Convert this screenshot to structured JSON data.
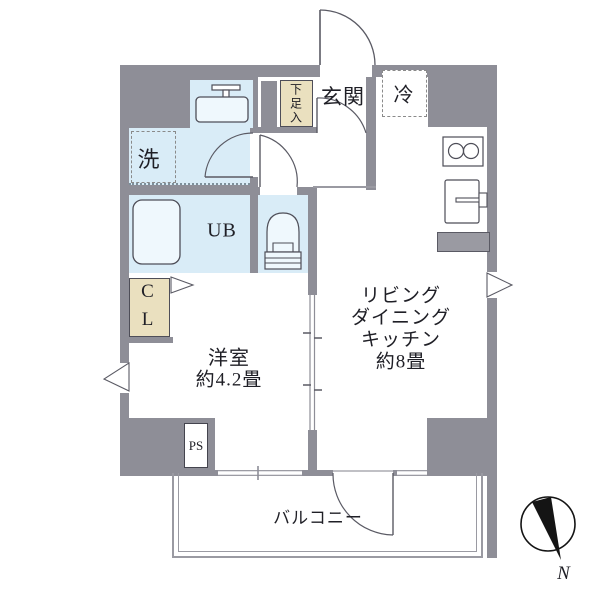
{
  "floor_plan": {
    "labels": {
      "genkan": "玄関",
      "refrigerator": "冷",
      "shoe_cabinet": "下足入",
      "washer": "洗",
      "unit_bath": "UB",
      "closet_lines": [
        "C",
        "L"
      ],
      "western_room": {
        "name": "洋室",
        "area": "約4.2畳"
      },
      "ldk_lines": [
        "リビング",
        "ダイニング",
        "キッチン",
        "約8畳"
      ],
      "pipe_space": "PS",
      "balcony": "バルコニー",
      "compass_north": "N"
    },
    "colors": {
      "wall": "#8e8e97",
      "wet_area_fill": "#d9ecf7",
      "storage_fill": "#eae0bf",
      "fixture_line": "#4e4e58"
    },
    "icons": {
      "compass": "compass-icon",
      "bathtub": "bathtub-icon",
      "toilet": "toilet-icon",
      "washbasin": "washbasin-icon",
      "stove": "stove-icon",
      "kitchen_sink": "kitchen-sink-icon",
      "doors": "door-arc-icon",
      "windows": "window-mark-icon"
    }
  }
}
